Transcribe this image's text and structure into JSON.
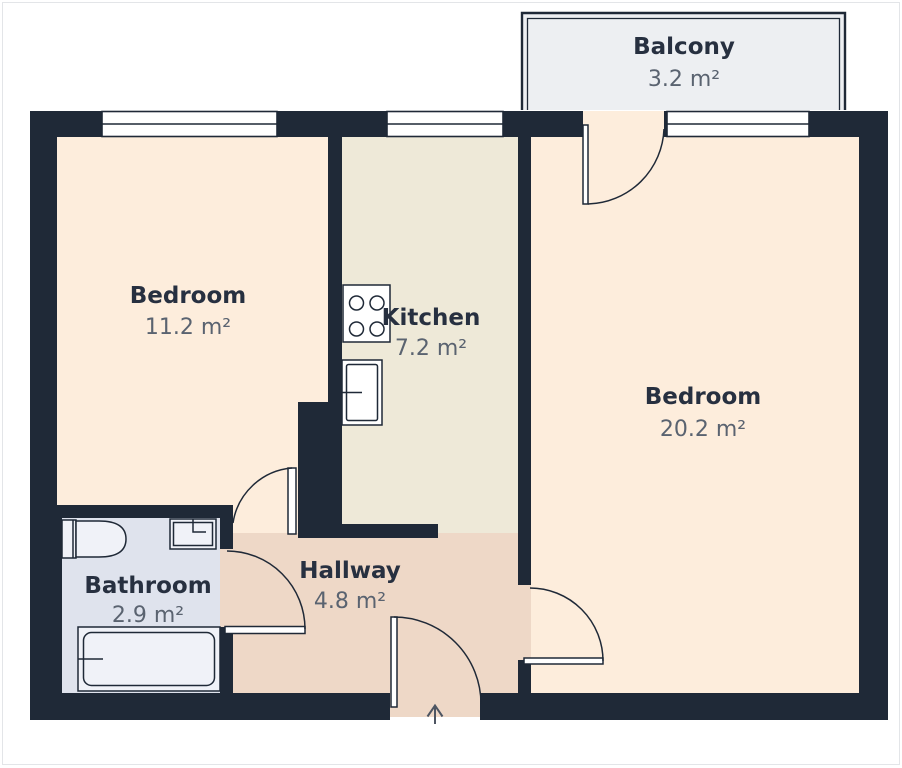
{
  "floor_plan": {
    "rooms": [
      {
        "name": "Balcony",
        "area": "3.2 m²"
      },
      {
        "name": "Bedroom",
        "area": "11.2 m²"
      },
      {
        "name": "Kitchen",
        "area": "7.2 m²"
      },
      {
        "name": "Bedroom",
        "area": "20.2 m²"
      },
      {
        "name": "Bathroom",
        "area": "2.9 m²"
      },
      {
        "name": "Hallway",
        "area": "4.8 m²"
      }
    ],
    "colors": {
      "wall": "#1f2937",
      "bedroom_fill": "#fdeddc",
      "kitchen_fill": "#eee9d8",
      "hallway_fill": "#eed8c7",
      "bathroom_fill": "#dfe3ed",
      "balcony_fill": "#edeff2",
      "window_fill": "#ffffff",
      "appliance_fill": "#ffffff",
      "fixture_fill": "#f0f2f8",
      "label_text": "#273040",
      "area_text": "#5a6370",
      "arrow": "#4d5562",
      "frame_border": "#e3e5e8"
    },
    "icons": [
      "window-icon",
      "door-swing-icon",
      "stove-icon",
      "kitchen-sink-icon",
      "toilet-icon",
      "bathroom-sink-icon",
      "bathtub-icon",
      "entrance-arrow-icon"
    ]
  }
}
